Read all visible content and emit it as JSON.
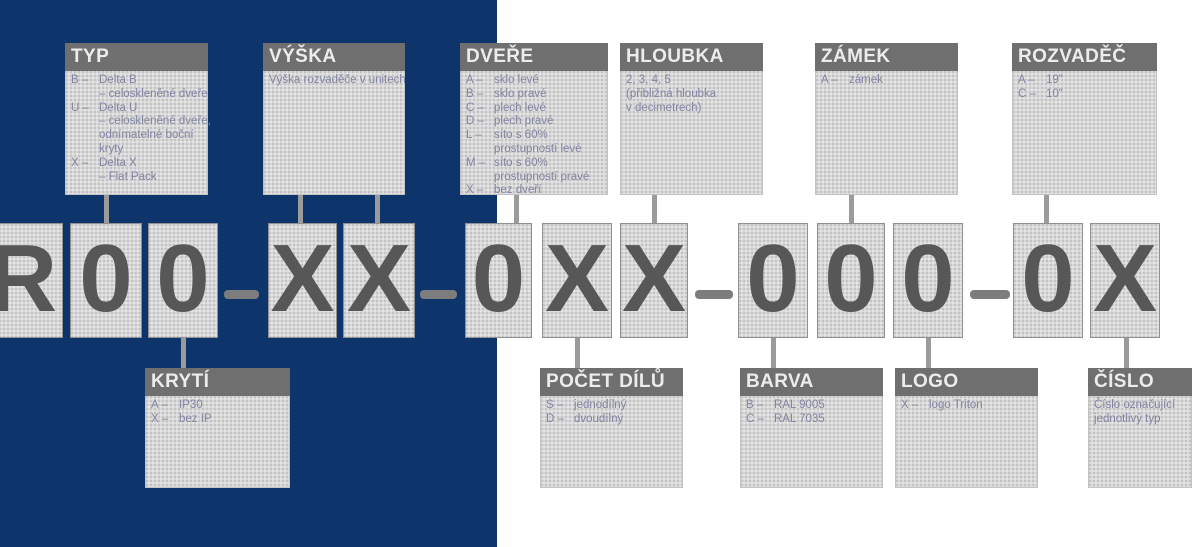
{
  "diagram": {
    "code_string": "R00-XX-0XX-000-0X",
    "code_chars": [
      "R",
      "0",
      "0",
      "X",
      "X",
      "0",
      "X",
      "X",
      "0",
      "0",
      "0",
      "0",
      "X"
    ],
    "colors": {
      "navy_background": "#0e356b",
      "header_gray": "#6f6f6f",
      "box_fill": "#d8d8d8",
      "code_char": "#575757",
      "body_text": "#8184a2",
      "connector": "#9b9b9b"
    },
    "top_callouts": [
      {
        "title": "TYP",
        "lines": [
          {
            "k": "B –",
            "t": "Delta B"
          },
          {
            "k": "",
            "t": "– celoskleněné dveře"
          },
          {
            "k": "U –",
            "t": "Delta U"
          },
          {
            "k": "",
            "t": "– celoskleněné dveře,"
          },
          {
            "k": "",
            "t": "odnímatelné boční"
          },
          {
            "k": "",
            "t": "kryty"
          },
          {
            "k": "X –",
            "t": "Delta X"
          },
          {
            "k": "",
            "t": "– Flat Pack"
          }
        ]
      },
      {
        "title": "VÝŠKA",
        "lines": [
          {
            "t": "Výška rozvaděče v unitech"
          }
        ]
      },
      {
        "title": "DVEŘE",
        "lines": [
          {
            "k": "A –",
            "t": "sklo levé"
          },
          {
            "k": "B –",
            "t": "sklo pravé"
          },
          {
            "k": "C –",
            "t": "plech levé"
          },
          {
            "k": "D –",
            "t": "plech pravé"
          },
          {
            "k": "L –",
            "t": "síto s 60%"
          },
          {
            "k": "",
            "t": "prostupností levé"
          },
          {
            "k": "M –",
            "t": "síto s 60%"
          },
          {
            "k": "",
            "t": "prostupností pravé"
          },
          {
            "k": "X –",
            "t": "bez dveří"
          }
        ]
      },
      {
        "title": "HLOUBKA",
        "lines": [
          {
            "t": "2, 3, 4, 5"
          },
          {
            "t": "(přibližná hloubka"
          },
          {
            "t": "v decimetrech)"
          }
        ]
      },
      {
        "title": "ZÁMEK",
        "lines": [
          {
            "k": "A –",
            "t": "zámek"
          }
        ]
      },
      {
        "title": "ROZVADĚČ",
        "lines": [
          {
            "k": "A –",
            "t": "19\""
          },
          {
            "k": "C –",
            "t": "10\""
          }
        ]
      }
    ],
    "bottom_callouts": [
      {
        "title": "KRYTÍ",
        "lines": [
          {
            "k": "A –",
            "t": "IP30"
          },
          {
            "k": "X –",
            "t": "bez IP"
          }
        ]
      },
      {
        "title": "POČET DÍLŮ",
        "lines": [
          {
            "k": "S –",
            "t": "jednodílný"
          },
          {
            "k": "D –",
            "t": "dvoudílný"
          }
        ]
      },
      {
        "title": "BARVA",
        "lines": [
          {
            "k": "B –",
            "t": "RAL 9005"
          },
          {
            "k": "C –",
            "t": "RAL 7035"
          }
        ]
      },
      {
        "title": "LOGO",
        "lines": [
          {
            "k": "X –",
            "t": "logo Triton"
          }
        ]
      },
      {
        "title": "ČÍSLO",
        "lines": [
          {
            "t": "Číslo označující"
          },
          {
            "t": "jednotlivý typ"
          }
        ]
      }
    ]
  }
}
